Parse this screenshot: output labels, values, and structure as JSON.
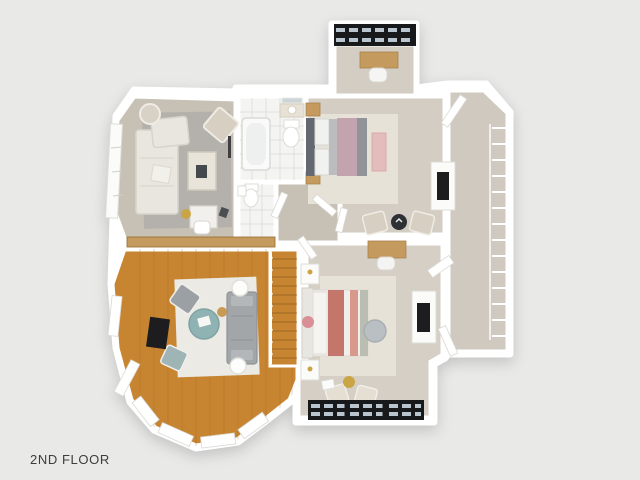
{
  "label": {
    "text": "2ND FLOOR"
  },
  "palette": {
    "background": "#e9e9e8",
    "wall": "#ffffff",
    "carpet_sitting": "#c7c0b4",
    "carpet_bedroom2": "#d3cdc3",
    "carpet_master": "#d5cfc5",
    "carpet_hall": "#c6c0b5",
    "carpet_closet": "#cfc9bf",
    "tile": "#f4f4f2",
    "wood_floor": "#c78531",
    "rug_gray": "#b4b1ac",
    "rug_cream": "#e7e2d7",
    "rug_white": "#eceae5",
    "sofa_white": "#e9e6df",
    "sofa_gray": "#a2a6a9",
    "teal_ottoman": "#8fb3b2",
    "tv_black": "#1d1d1f",
    "window_frame_black": "#17191b",
    "bed2_blanket_pink": "#c3a3ad",
    "bed2_runner_gray": "#909398",
    "bed2_headboard": "#646871",
    "bench_pink": "#e3bcbc",
    "master_coral": "#c4766a",
    "wood_furniture": "#c49a5e",
    "chair_beige": "#d6cfc2",
    "gold_accent": "#c9a545",
    "label_color": "#3d3d3d"
  }
}
